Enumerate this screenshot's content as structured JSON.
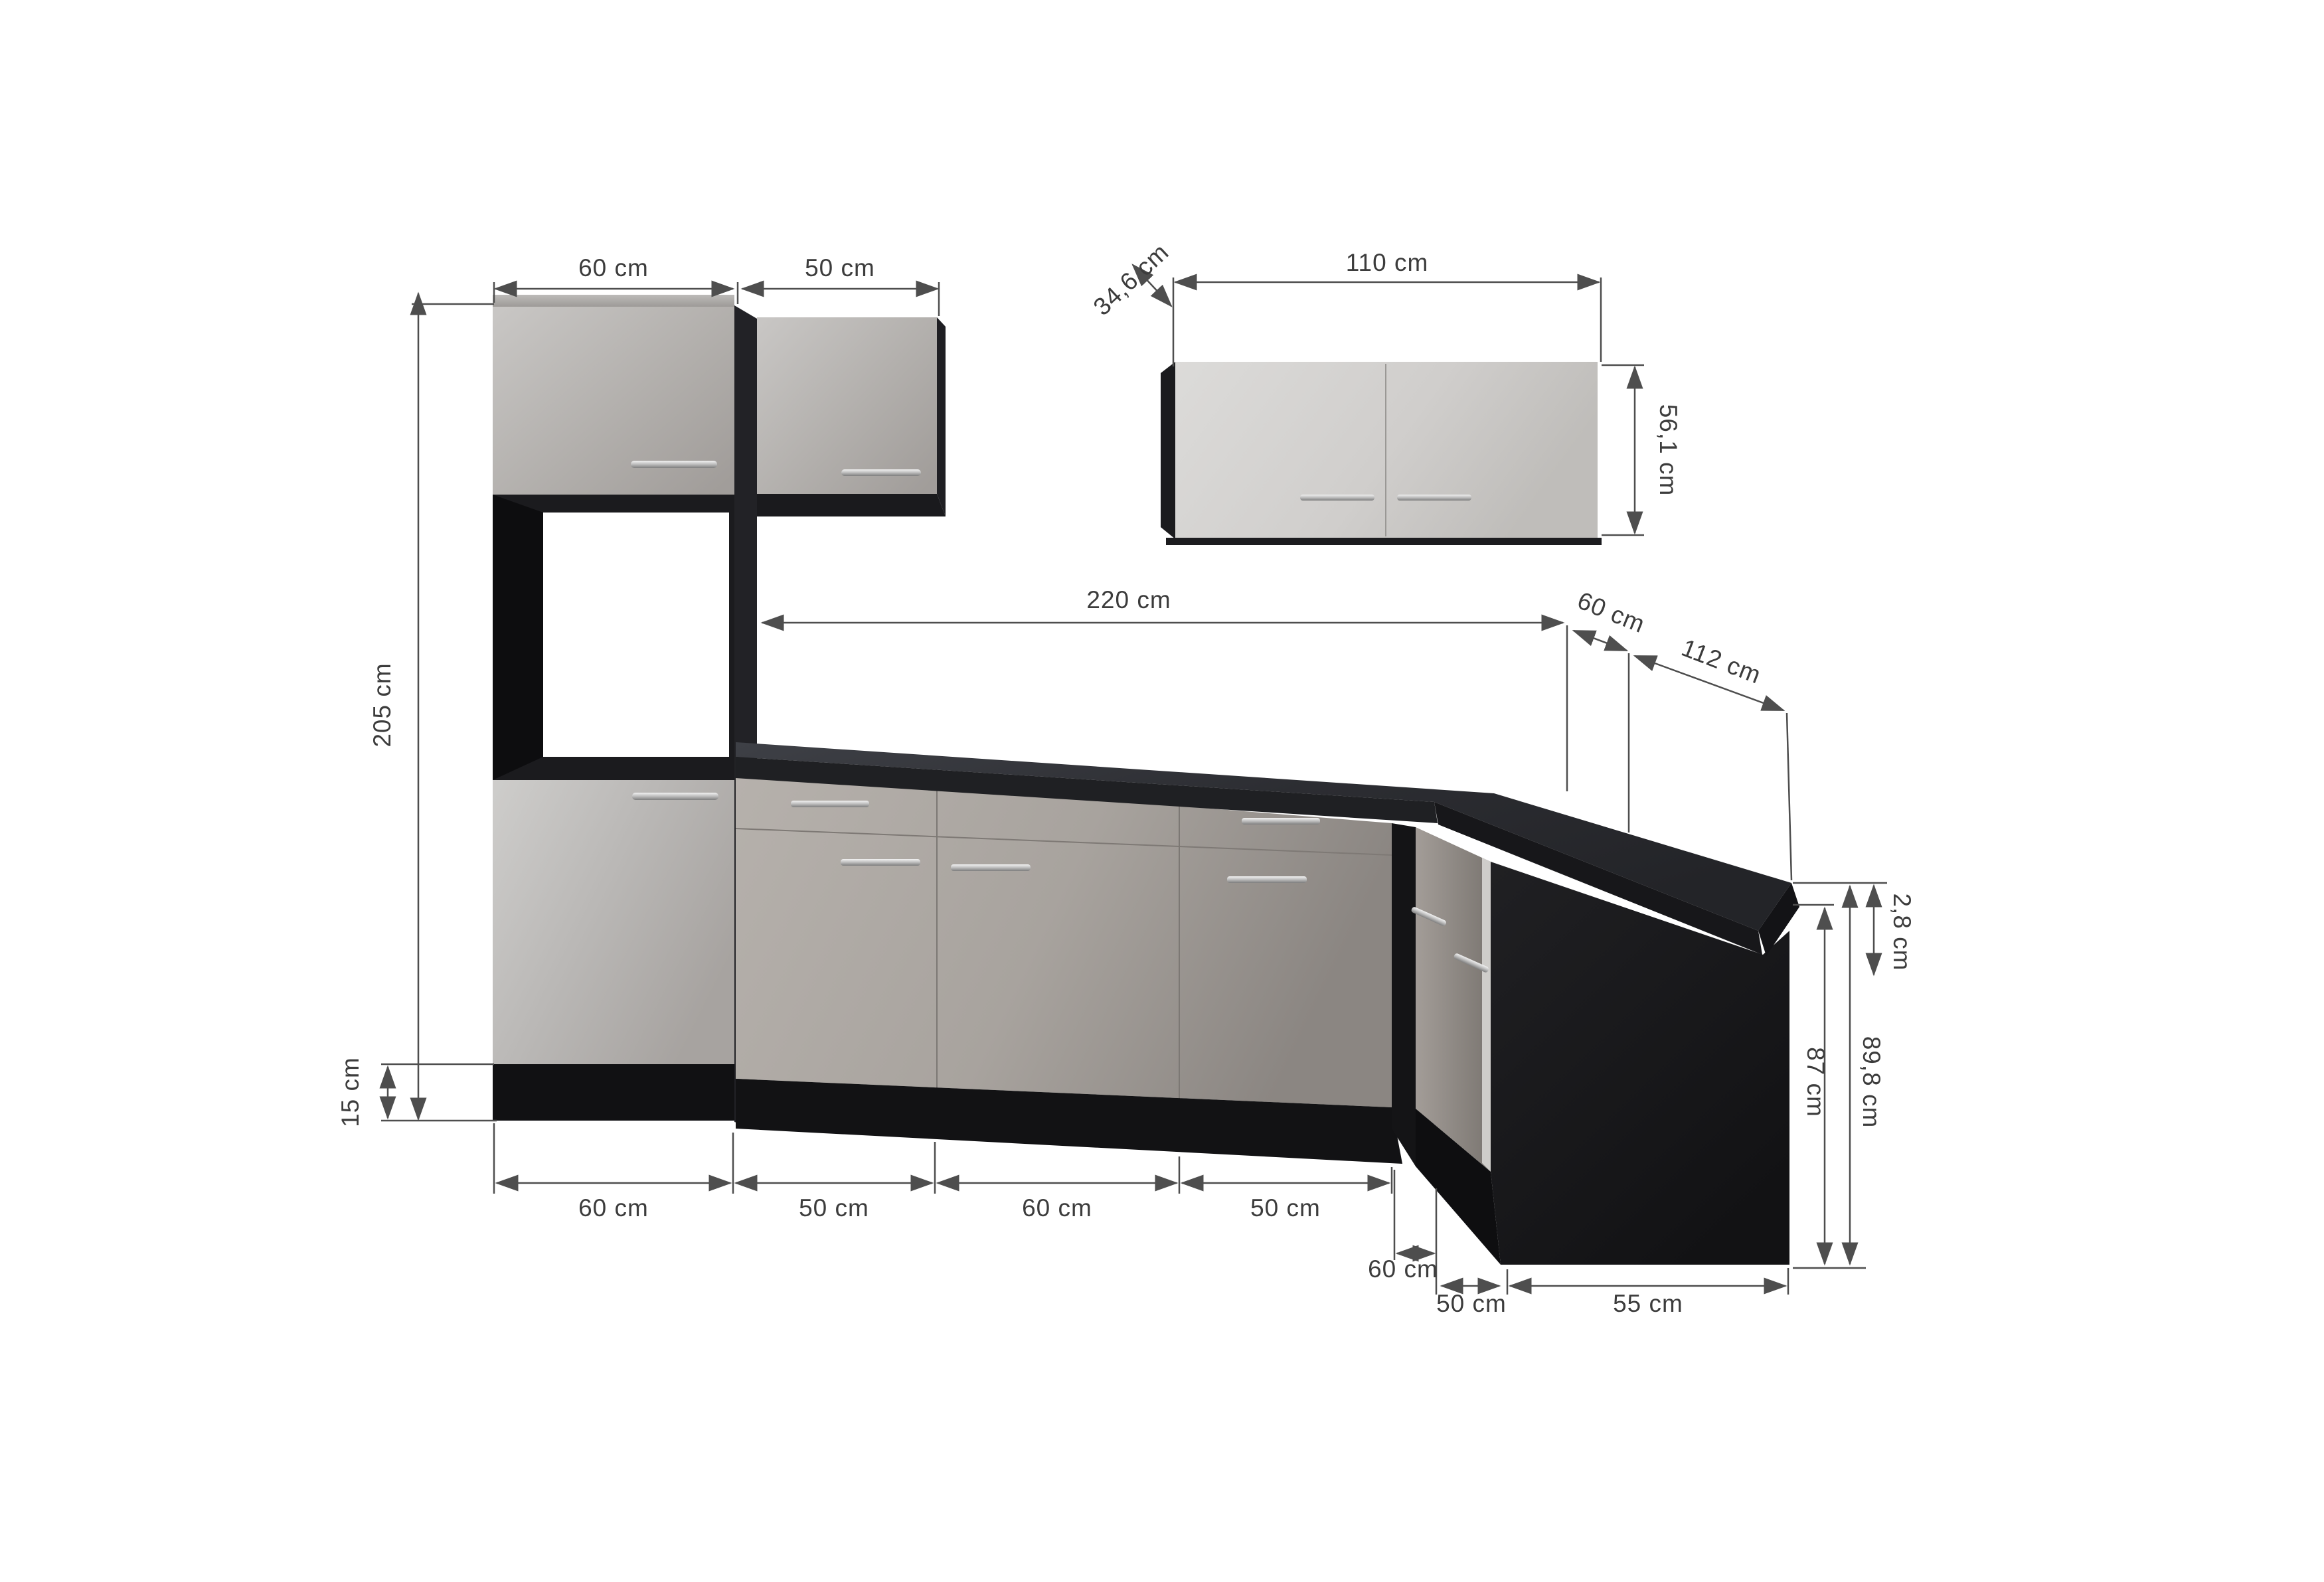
{
  "diagram": {
    "type": "kitchen-dimension-diagram",
    "units": "cm",
    "labels": {
      "upper_cabinet_width": "60 cm",
      "upper_cabinet2_width": "50 cm",
      "wall_cabinet_width": "110 cm",
      "wall_cabinet_depth": "34,6 cm",
      "wall_cabinet_height": "56,1 cm",
      "tall_unit_height": "205 cm",
      "plinth_height": "15 cm",
      "worktop_length": "220 cm",
      "corner_return_depth": "60 cm",
      "return_length": "112 cm",
      "base_width_1": "60 cm",
      "base_width_2": "50 cm",
      "base_width_3": "60 cm",
      "base_width_4": "50 cm",
      "corner_front_width": "60 cm",
      "return_cabinet_width": "50 cm",
      "return_side_depth": "55 cm",
      "worktop_thickness": "2,8 cm",
      "carcass_height": "87 cm",
      "total_base_height": "89,8 cm"
    },
    "colors": {
      "dimension_line": "#4e4e4e",
      "label_text": "#3c3c3c",
      "front_light_grey": "#c7c5c3",
      "front_mid_grey": "#a8a4a0",
      "base_grey": "#b0aba6",
      "carcass_black": "#161618",
      "worktop_charcoal": "#33343a",
      "side_panel_black": "#1a1a1d",
      "background": "#ffffff"
    }
  }
}
